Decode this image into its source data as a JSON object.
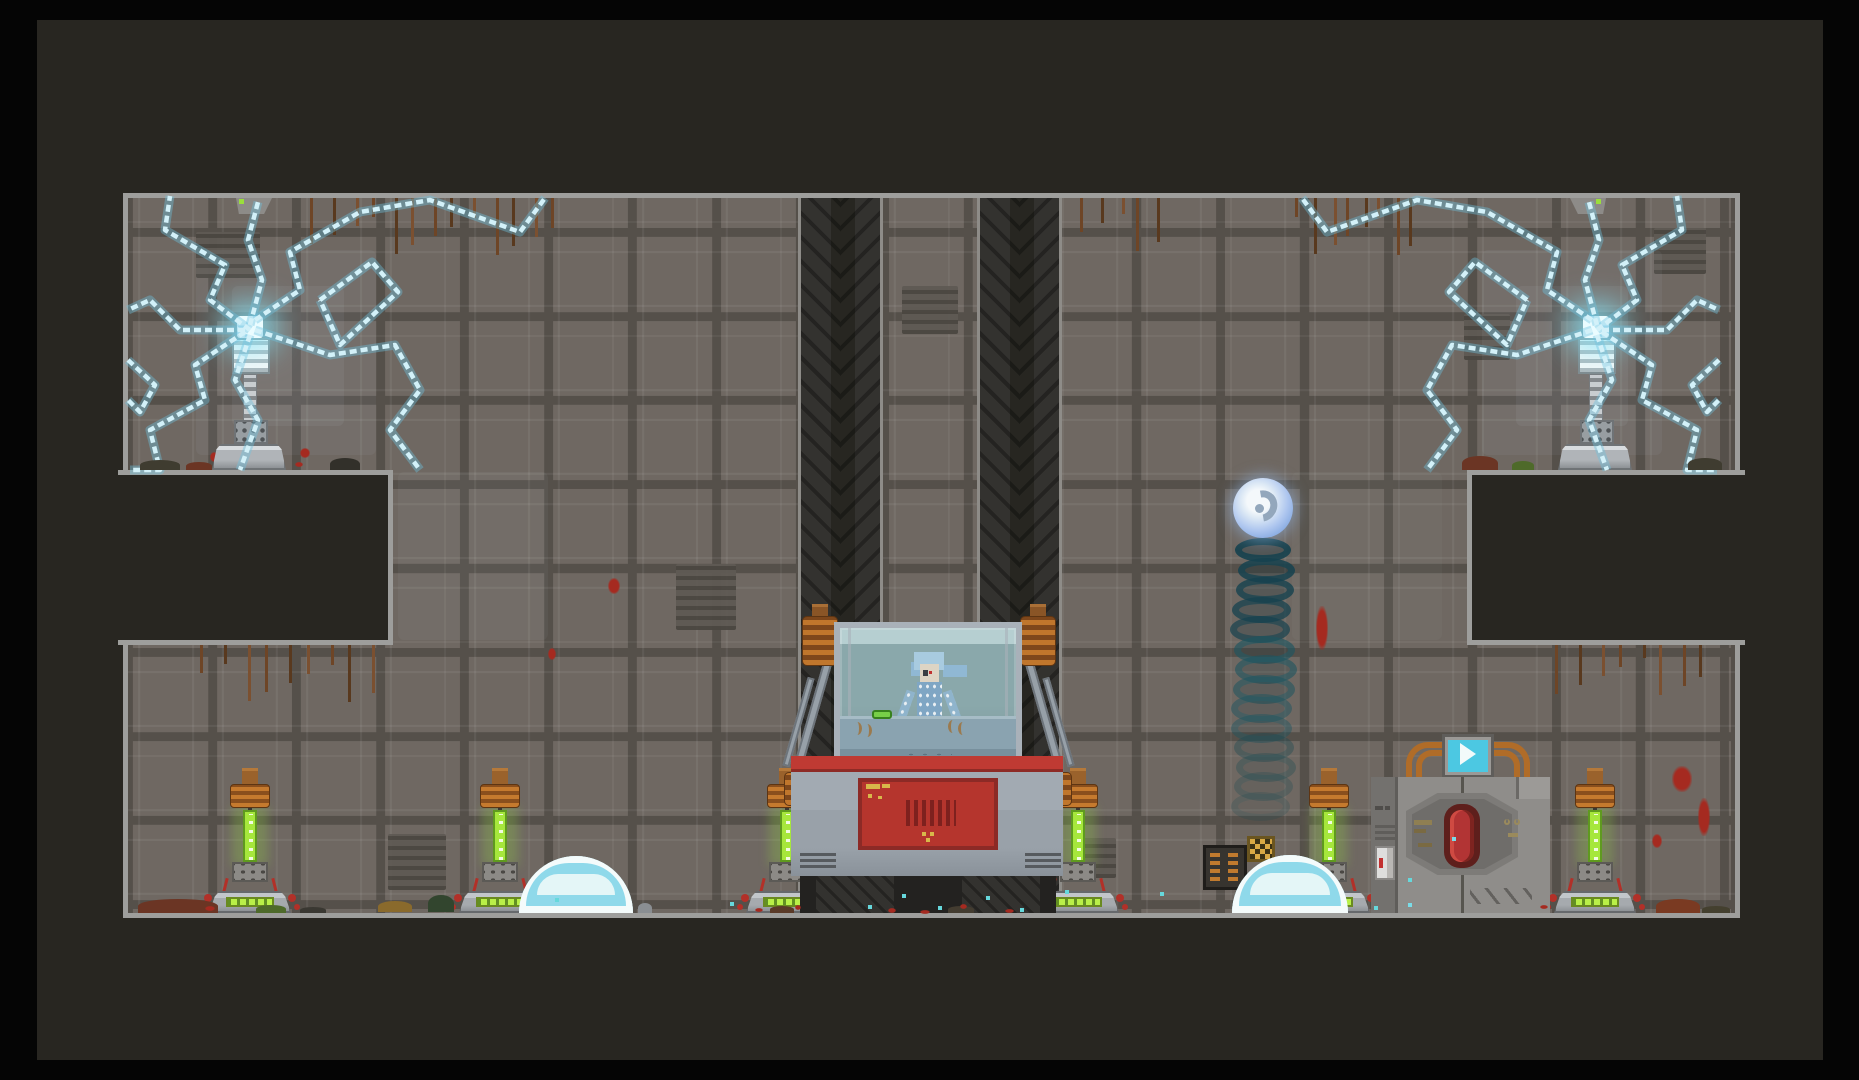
{
  "meta": {
    "type": "game-screenshot",
    "genre": "2D pixel-art sci-fi platformer",
    "visible_text": "none"
  },
  "scene": {
    "room": {
      "label": "laboratory chamber",
      "shape": "cross-section with stepped side alcoves",
      "wall": "gray riveted tile panels"
    },
    "entities": [
      {
        "name": "tesla-coil",
        "count": 2,
        "state": "arcing cyan lightning",
        "position": "upper-left and upper-right alcoves"
      },
      {
        "name": "ceiling-mount",
        "count": 2,
        "indicator_color": "#9ade3c"
      },
      {
        "name": "elevator-pillar",
        "count": 2,
        "texture": "dark chevron"
      },
      {
        "name": "stasis-pod",
        "count": 1,
        "occupant": "skeleton",
        "window": "glass",
        "body_panel": "red"
      },
      {
        "name": "skeleton",
        "count": 1,
        "tint": "pale blue"
      },
      {
        "name": "energy-orb",
        "count": 1,
        "state": "descending with teal ring trail"
      },
      {
        "name": "energy-pylon",
        "count": 6,
        "rod_color": "#a6e73c",
        "coil_color": "#c57a2e"
      },
      {
        "name": "shield-dome",
        "count": 2,
        "rim": "white and cyan"
      },
      {
        "name": "exit-door",
        "count": 1,
        "centerpiece": "red capsule in hex panel"
      },
      {
        "name": "door-monitor",
        "count": 1,
        "screen_glyph": "play-triangle"
      },
      {
        "name": "supply-rack",
        "count": 1
      },
      {
        "name": "hazard-plate",
        "count": 1,
        "pattern": "checker"
      },
      {
        "name": "roots",
        "clusters": 5
      },
      {
        "name": "debris",
        "note": "dirt mounds, blood splatters, teal specks along floors"
      }
    ],
    "colors": {
      "background": "#050505",
      "panel": "#282621",
      "wall": "#6f6862",
      "grout": "#55504a",
      "border": "#9e9e9c",
      "lightning": "#d3f1f9",
      "pylon_green": "#a6e73c",
      "machine_red": "#b5352d",
      "orb_blue": "#aec6ef",
      "trail_teal": "#1d4a5c",
      "screen_cyan": "#4cc8e2",
      "dome_cyan": "#8fd9ea",
      "coil_orange": "#c0762c",
      "root_brown": "#6e4526"
    }
  }
}
